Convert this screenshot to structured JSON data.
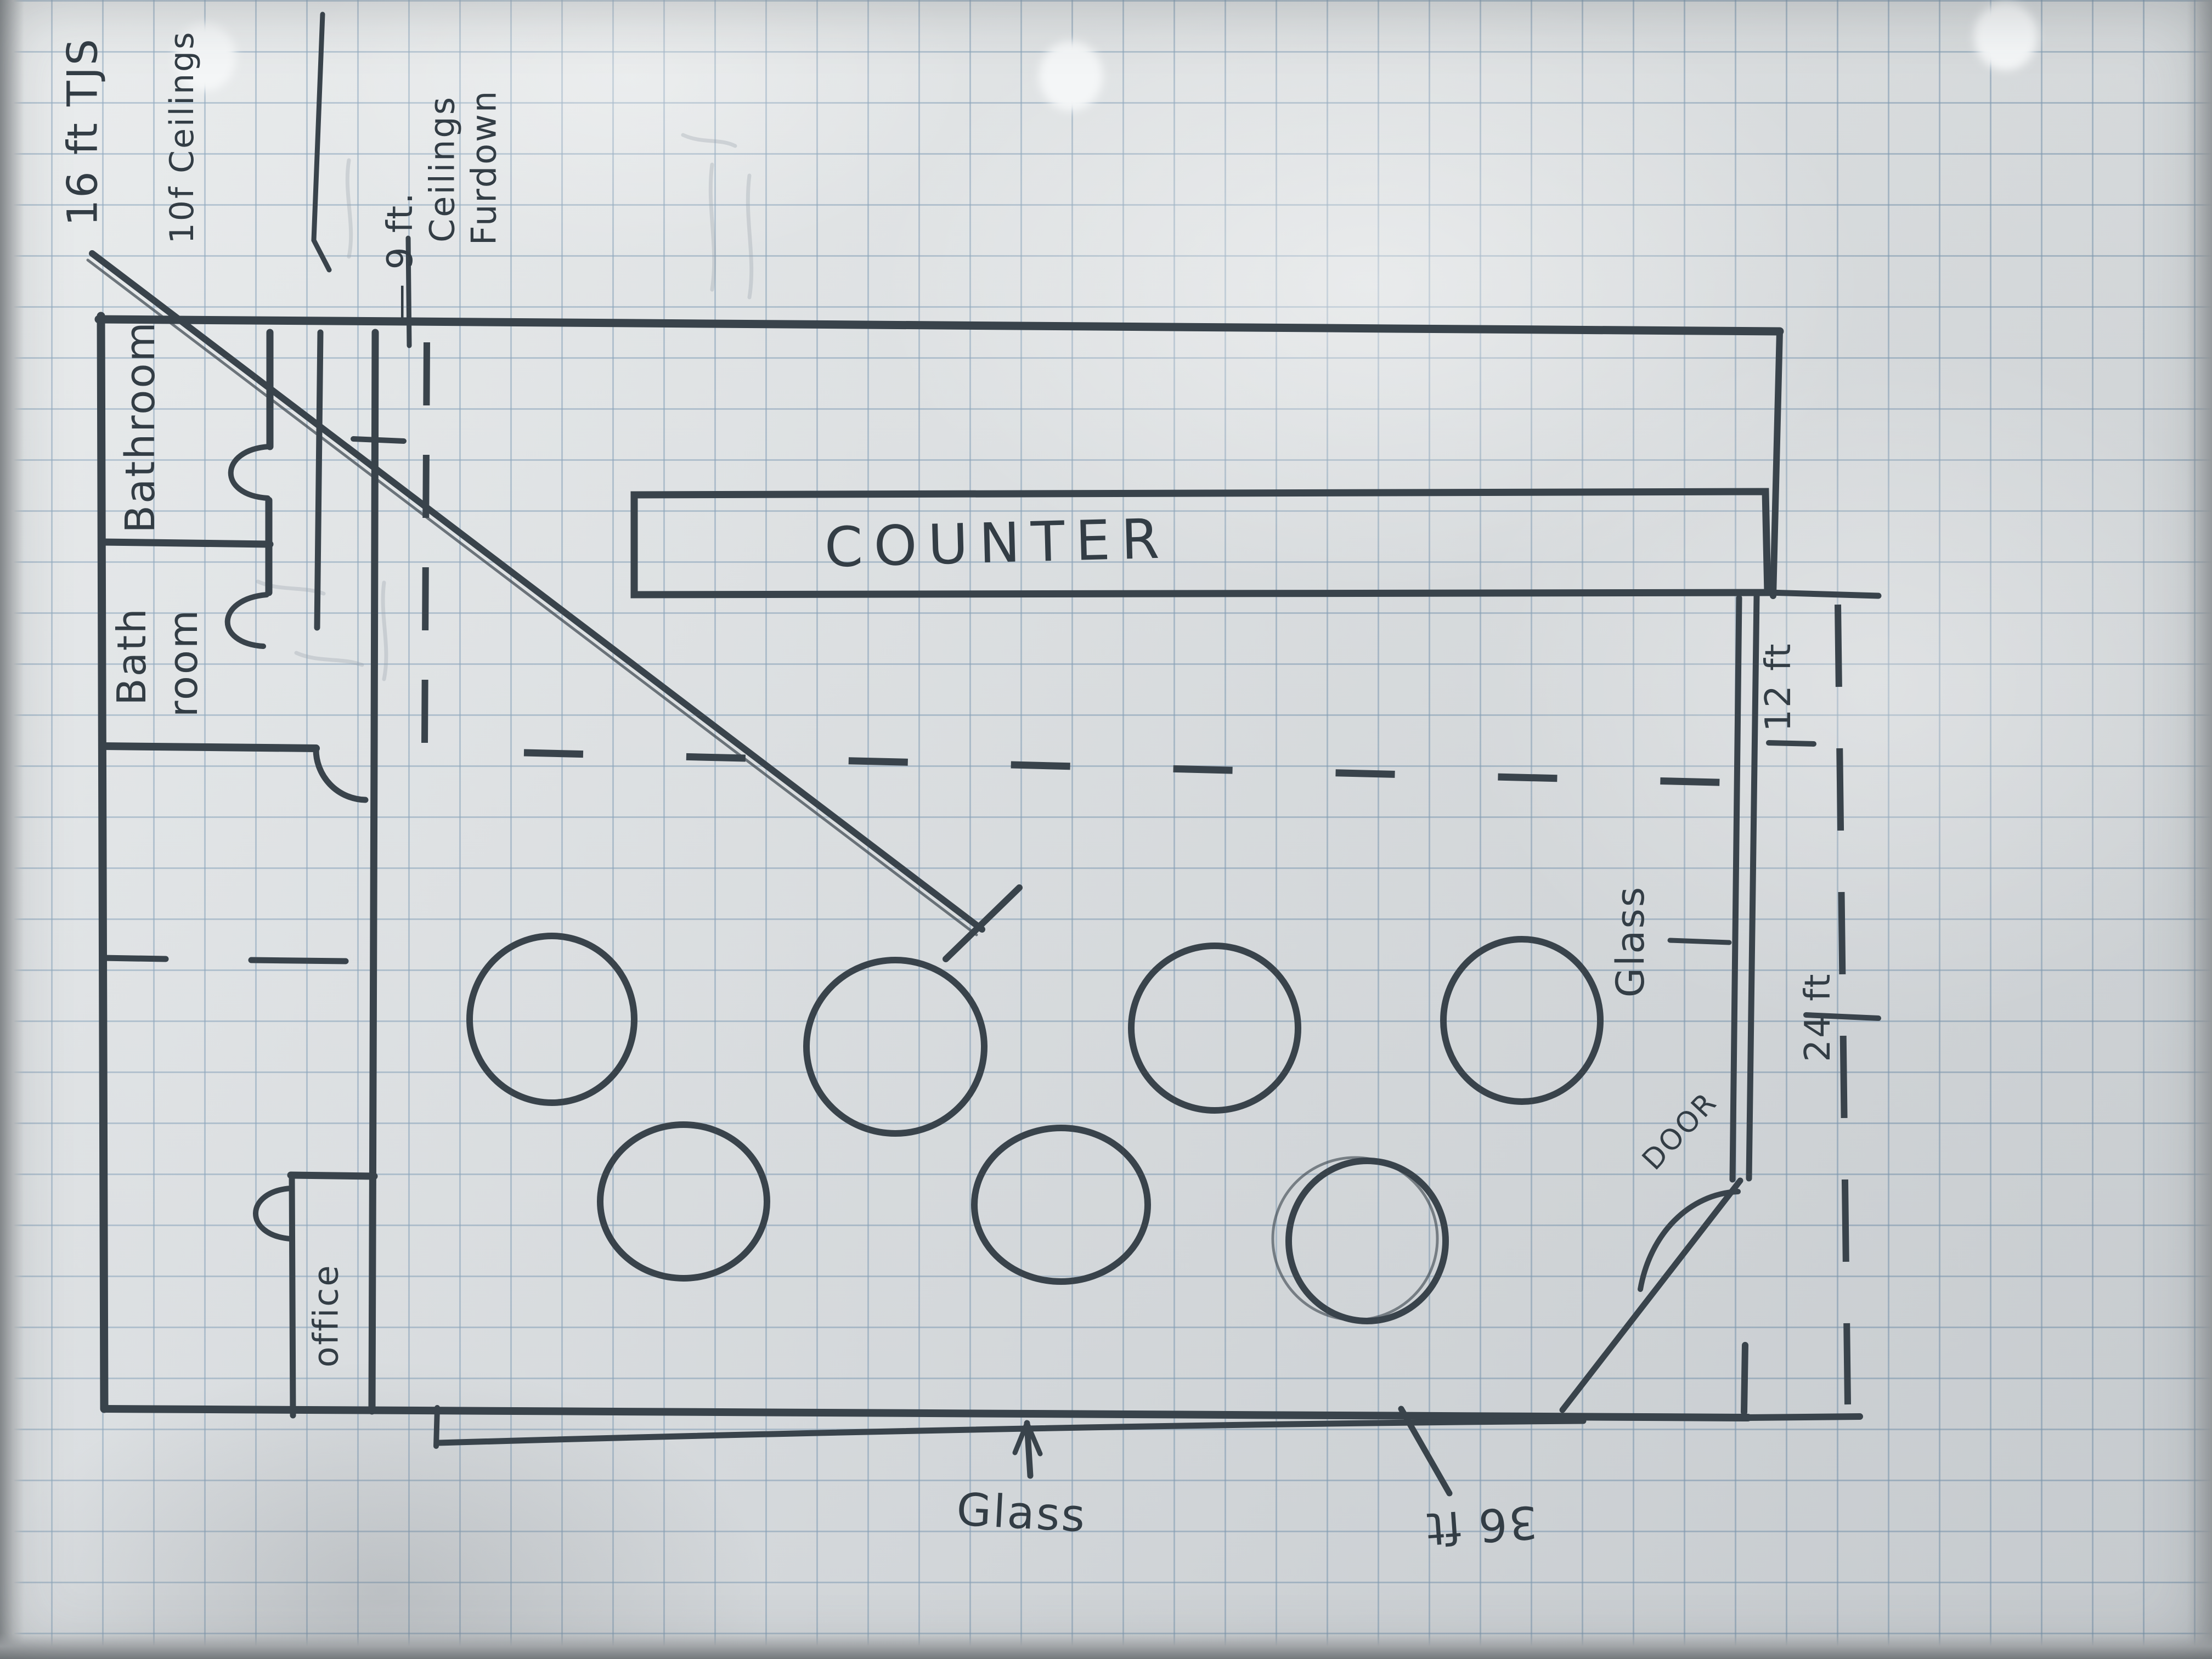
{
  "annotations": {
    "joists": "16 ft TJS",
    "ceilings_high": "10f Ceilings",
    "ceilings_low": [
      "— 9 ft.",
      "Ceilings",
      "Furdown"
    ]
  },
  "rooms": {
    "bathroom_top": "Bathroom",
    "bathroom_bottom": [
      "Bath",
      "room"
    ],
    "office": "office"
  },
  "counter_label": "COUNTER",
  "glass_front": "Glass",
  "glass_side": "Glass",
  "door_label": "DOOR",
  "dimensions": {
    "storefront": "36 ft",
    "side_depth": "24 ft",
    "side_width": "12 ft"
  },
  "colors": {
    "ink": "#39434b",
    "grid": "#9db4c8",
    "paper": "#e2e5e7",
    "pencil": "#98a2ab"
  }
}
